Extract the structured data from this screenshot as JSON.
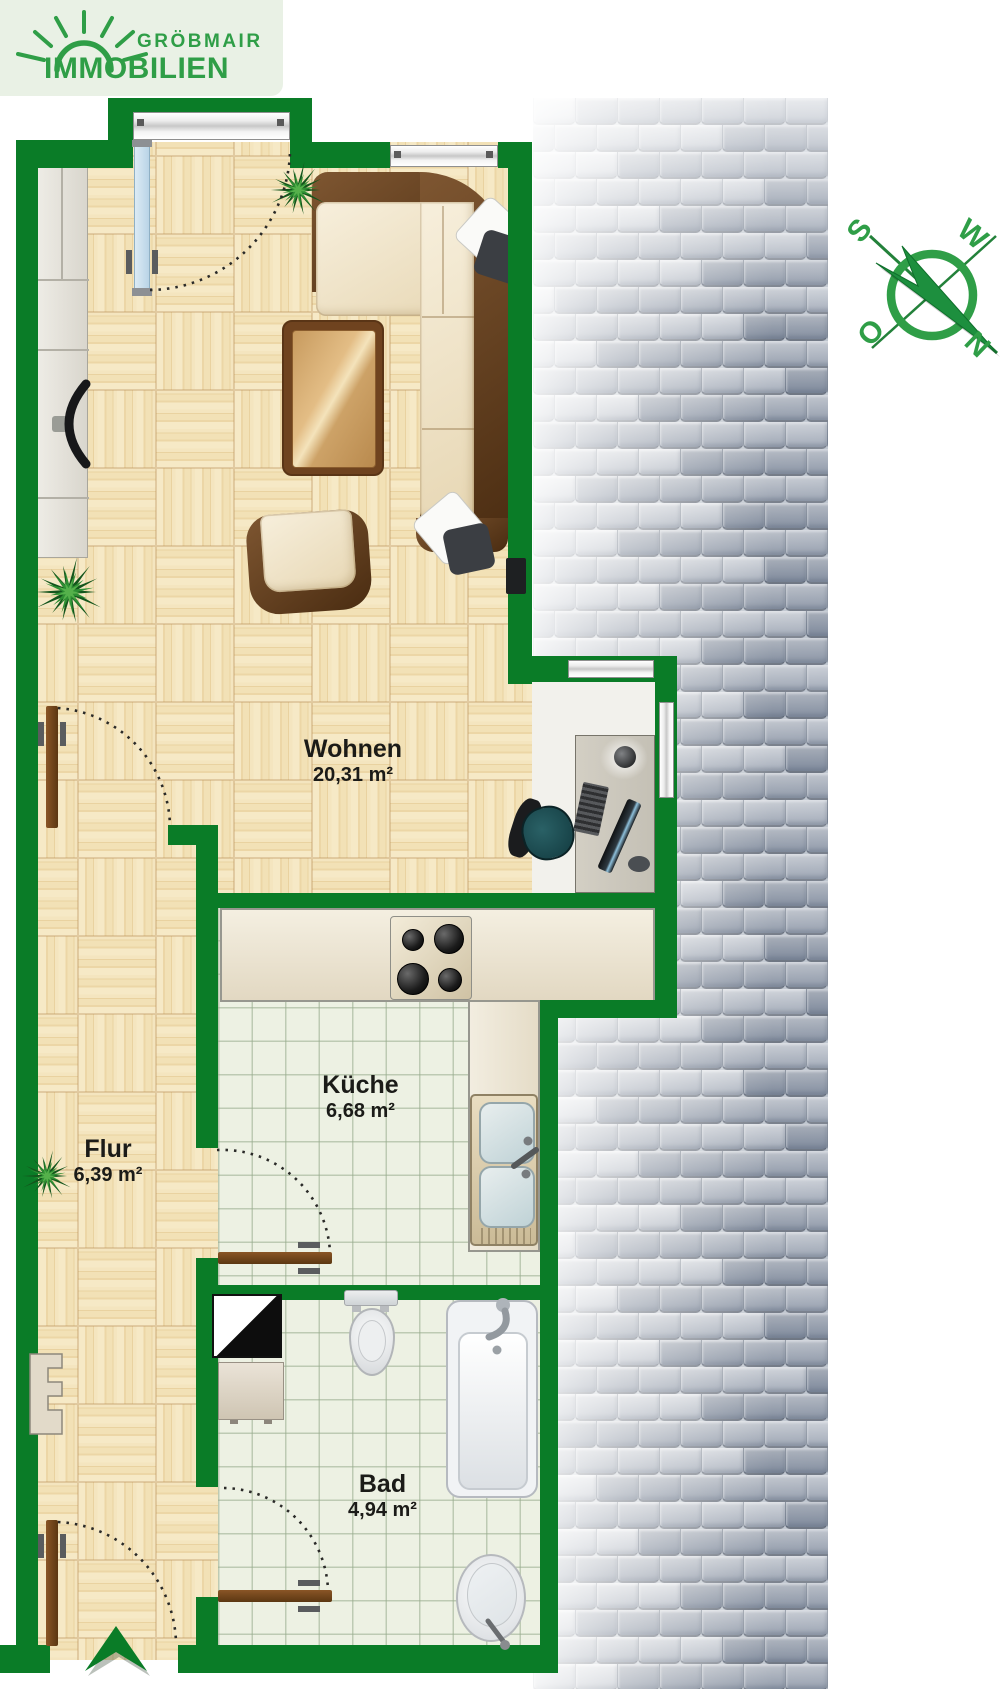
{
  "brand": {
    "line1": "GRÖBMAIR",
    "line2": "IMMOBILIEN"
  },
  "compass": {
    "south": "S",
    "west": "W",
    "east": "O",
    "north": "N"
  },
  "rooms": {
    "wohnen": {
      "name": "Wohnen",
      "area": "20,31 m²"
    },
    "kueche": {
      "name": "Küche",
      "area": "6,68 m²"
    },
    "flur": {
      "name": "Flur",
      "area": "6,39 m²"
    },
    "bad": {
      "name": "Bad",
      "area": "4,94 m²"
    }
  },
  "colors": {
    "wall_green": "#0a7c27",
    "brand_green": "#2f9e47",
    "parquet": "#f2e4bc",
    "tile_floor": "#edf1e3",
    "label_text": "#1b1b18"
  }
}
